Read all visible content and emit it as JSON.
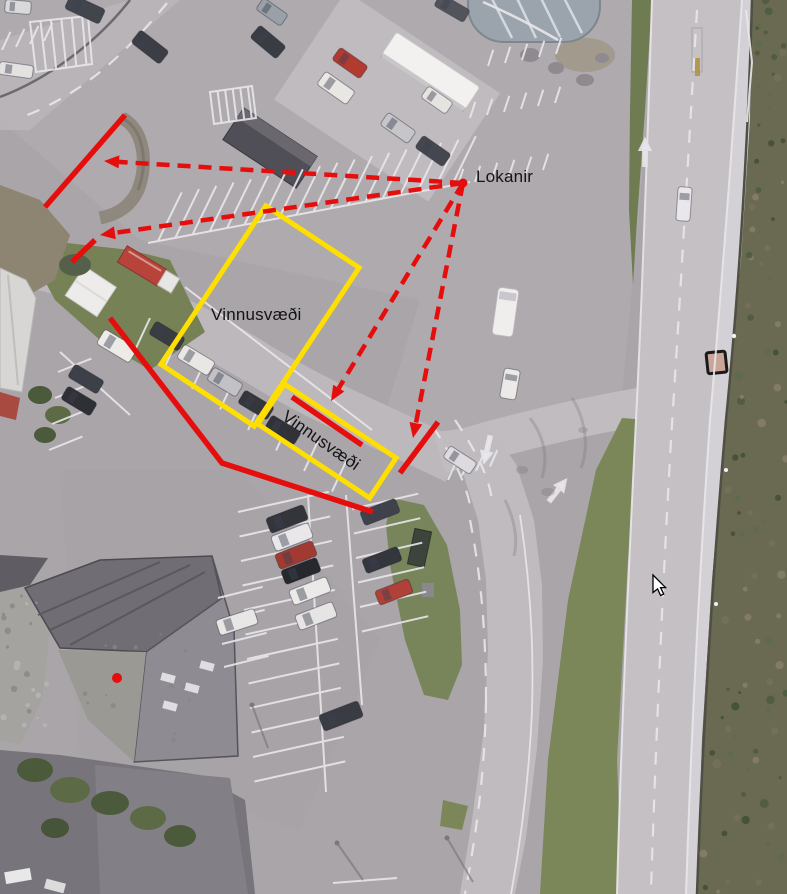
{
  "scene": {
    "description": "Aerial orthophoto of a parking area, service station and adjacent road, annotated with traffic-control markup: red closure lines, red dashed leader arrows from the word Lokanir, yellow work-area rectangles labelled Vinnusvæði, and a mouse cursor."
  },
  "colors": {
    "closure_red": "#e60d0d",
    "work_area_yellow": "#ffdf00",
    "label_black": "#141414",
    "asphalt_gray": "#a9a5a9",
    "road_gray": "#c4c0c4",
    "grass_green": "#78855a",
    "vegetation_dark": "#6a6a52"
  },
  "annotation": {
    "labels": {
      "lokanir": {
        "text": "Lokanir",
        "x": 476,
        "y": 182,
        "rotate": 0
      },
      "work_area_1": {
        "text": "Vinnusvæði",
        "x": 211,
        "y": 320,
        "rotate": 0
      },
      "work_area_2": {
        "text": "Vinnusvæði",
        "x": 281,
        "y": 419,
        "rotate": 35
      }
    },
    "closure_lines": [
      {
        "id": "closure-line-top-left",
        "points": [
          [
            125,
            115
          ],
          [
            45,
            207
          ]
        ]
      },
      {
        "id": "closure-line-left-short",
        "points": [
          [
            95,
            240
          ],
          [
            72,
            262
          ]
        ]
      },
      {
        "id": "closure-line-southwest",
        "points": [
          [
            110,
            318
          ],
          [
            222,
            463
          ],
          [
            373,
            512
          ]
        ]
      },
      {
        "id": "closure-line-in-work-area",
        "points": [
          [
            292,
            397
          ],
          [
            362,
            445
          ]
        ]
      },
      {
        "id": "closure-line-road-east",
        "points": [
          [
            438,
            422
          ],
          [
            400,
            473
          ]
        ]
      }
    ],
    "leader_origin": [
      463,
      183
    ],
    "leader_arrows": [
      {
        "id": "leader-arrow-upper-left",
        "tip": [
          104,
          161
        ]
      },
      {
        "id": "leader-arrow-left",
        "tip": [
          100,
          235
        ]
      },
      {
        "id": "leader-arrow-lower-middle",
        "tip": [
          331,
          401
        ]
      },
      {
        "id": "leader-arrow-lower-right",
        "tip": [
          413,
          438
        ]
      }
    ],
    "work_area_boxes": [
      {
        "id": "work-area-box-large",
        "cx": 260,
        "cy": 316,
        "w": 112,
        "h": 190,
        "rotate": 33.5
      },
      {
        "id": "work-area-box-small",
        "cx": 327,
        "cy": 441,
        "w": 134,
        "h": 48,
        "rotate": 33.5
      }
    ],
    "marker_dot": [
      117,
      678
    ],
    "style": {
      "line_width": 5.5,
      "dash": "13 8",
      "dash_width": 4.5,
      "box_stroke_width": 5,
      "arrow_head_len": 15,
      "arrow_head_halfwidth": 6.5
    }
  },
  "cursor": {
    "x": 653,
    "y": 575
  }
}
